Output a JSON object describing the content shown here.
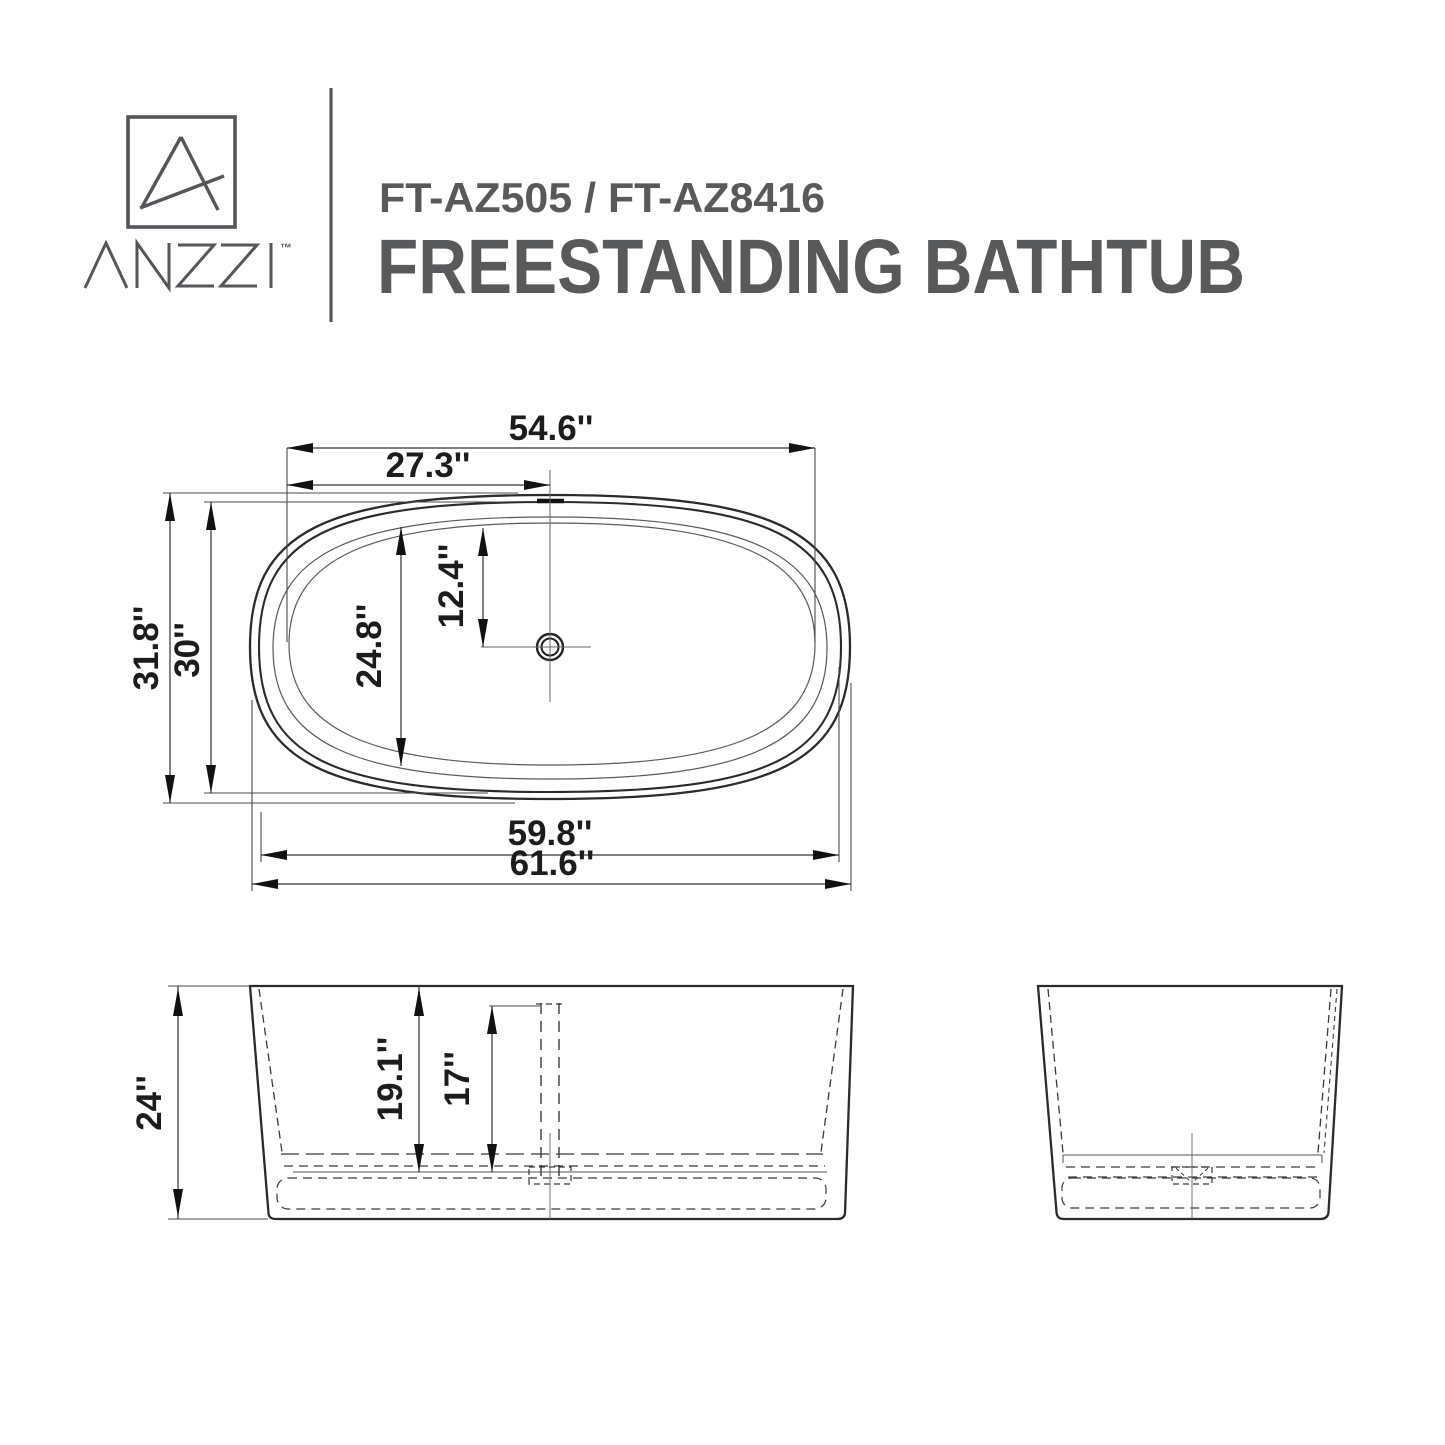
{
  "header": {
    "brand": "ANZZI",
    "trademark": "™",
    "model": "FT-AZ505 / FT-AZ8416",
    "product": "FREESTANDING BATHTUB",
    "text_color": "#58595B"
  },
  "drawing": {
    "line_color": "#231F20",
    "background_color": "#FFFFFF"
  },
  "dimensions": {
    "top": {
      "basin_length": "54.6''",
      "drain_offset_length": "27.3''",
      "overall_width": "31.8''",
      "rim_width": "30''",
      "basin_width": "24.8''",
      "drain_offset_width": "12.4''",
      "rim_length": "59.8''",
      "overall_length": "61.6''"
    },
    "front": {
      "overall_height": "24''",
      "inner_depth": "19.1''",
      "water_depth": "17''"
    }
  }
}
